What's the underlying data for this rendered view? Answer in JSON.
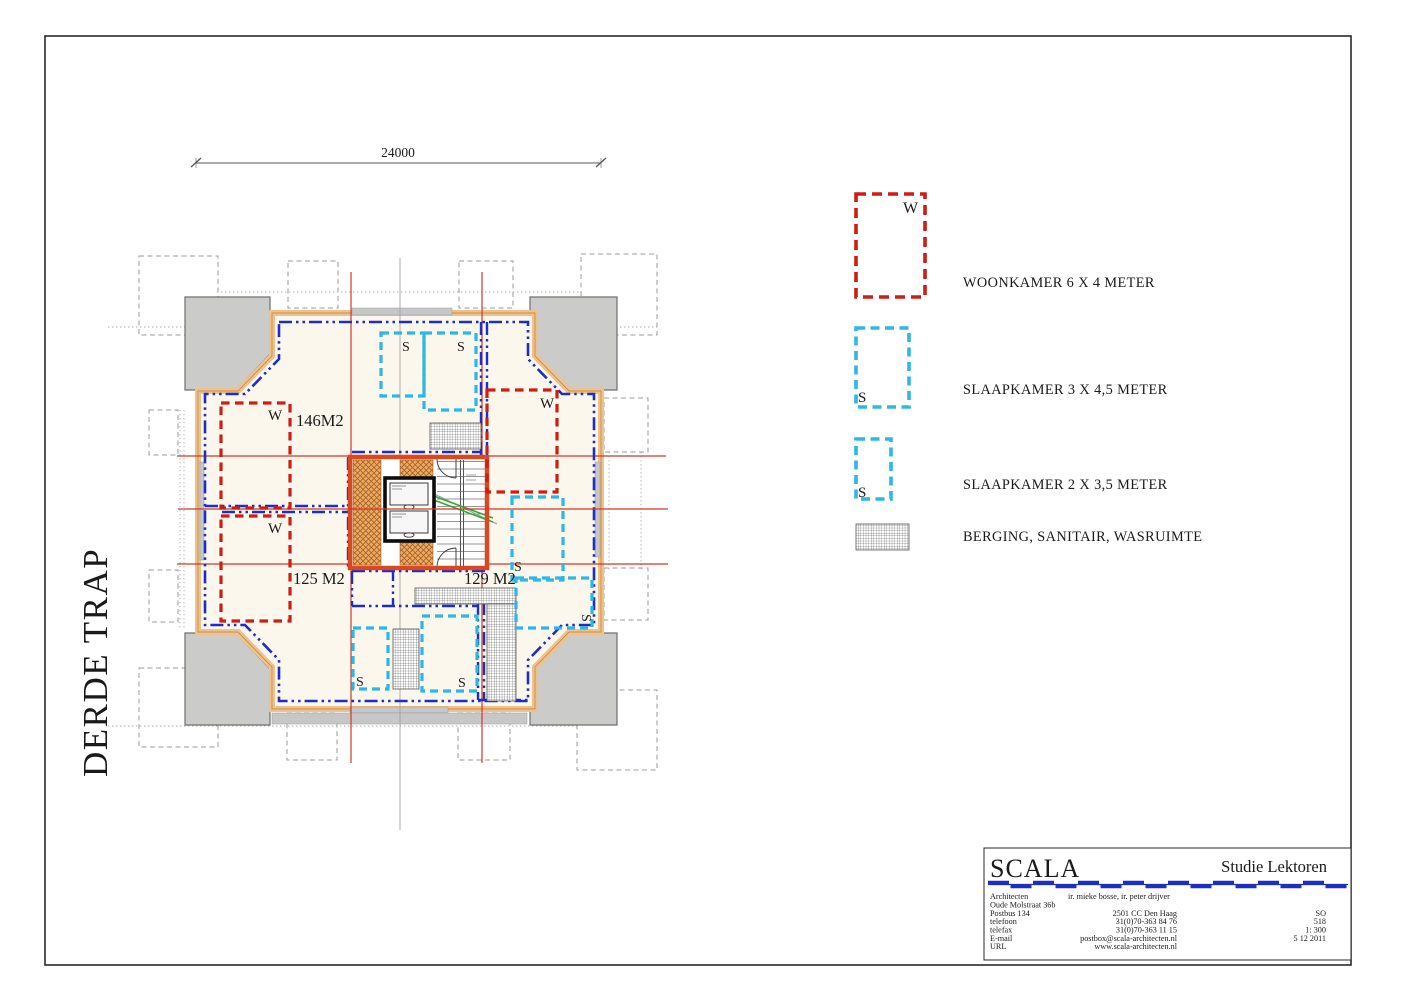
{
  "sheet": {
    "plan_title_vertical": "DERDE TRAP",
    "dimension_top": "24000",
    "area_label_top_left": "146M2",
    "area_label_bottom_left": "125 M2",
    "area_label_bottom_right": "129 M2",
    "marker_woonkamer": "W",
    "marker_slaapkamer": "S"
  },
  "legend": {
    "items": [
      {
        "marker": "W",
        "label": "WOONKAMER 6 X 4 METER"
      },
      {
        "marker": "S",
        "label": "SLAAPKAMER 3 X 4,5 METER"
      },
      {
        "marker": "S",
        "label": "SLAAPKAMER 2 X 3,5 METER"
      },
      {
        "marker": "",
        "label": "BERGING, SANITAIR, WASRUIMTE"
      }
    ]
  },
  "title_block": {
    "firm": "SCALA",
    "project": "Studie Lektoren",
    "rows": [
      {
        "label": "Architecten",
        "value": "ir. mieke bosse, ir. peter drijver",
        "extra": ""
      },
      {
        "label": "Oude Molstraat 36b",
        "value": "",
        "extra": ""
      },
      {
        "label": "Postbus 134",
        "value": "2501 CC Den Haag",
        "extra": "SO"
      },
      {
        "label": "telefoon",
        "value": "31(0)70-363 84 76",
        "extra": "518"
      },
      {
        "label": "telefax",
        "value": "31(0)70-363 11 15",
        "extra": "1: 300"
      },
      {
        "label": "E-mail",
        "value": "postbox@scala-architecten.nl",
        "extra": "5 12 2011"
      },
      {
        "label": "URL",
        "value": "www.scala-architecten.nl",
        "extra": ""
      }
    ]
  },
  "colors": {
    "partition_blue": "#1b2ec8",
    "woonkamer_red": "#ce1d12",
    "slaapkamer_cyan": "#2cb7e6",
    "core_border_orange": "#d9481f",
    "axis_red": "#cf3a28",
    "stair_green": "#3aa83a",
    "wall_tan": "#f1c189",
    "floor_beige": "#fcf7ec",
    "block_gray": "#cbcbc9",
    "titleblock_blue": "#1b2ec8"
  }
}
